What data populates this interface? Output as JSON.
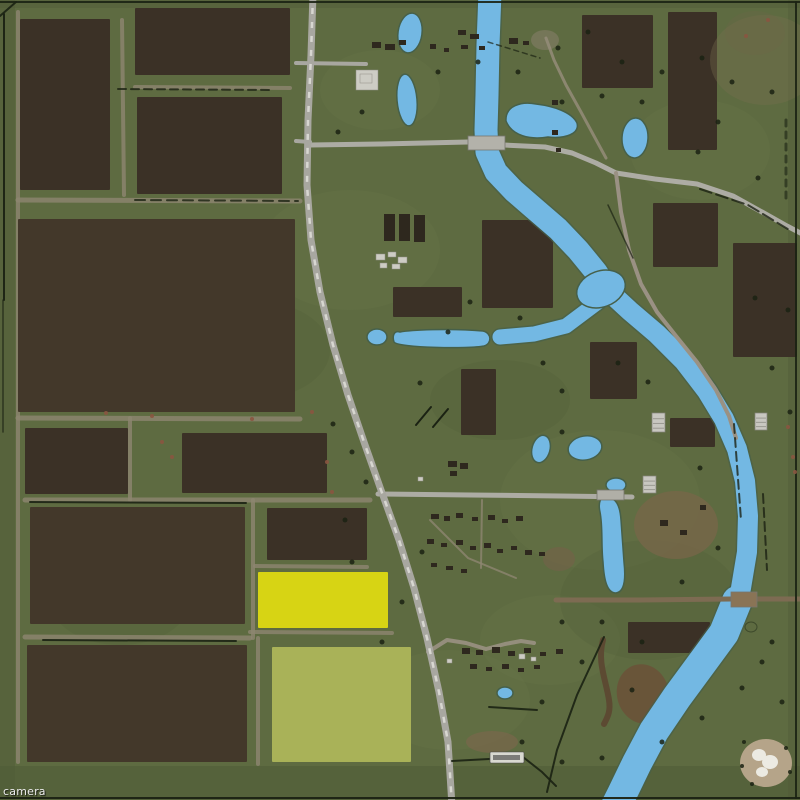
{
  "editor": {
    "camera_label": "camera"
  },
  "colors": {
    "grass": "#5e6b41",
    "water": "#73b8e3",
    "water_edge": "#46604a",
    "field_dark": "#3b3126",
    "field_dark2": "#43382a",
    "field_yellow": "#d7d414",
    "field_olive": "#a9b258",
    "road_light": "#a8a7a0",
    "road_dash": "#d8d7d1",
    "dirt_trail": "#8d8671",
    "tree": "#1b2213",
    "building_dark": "#2e281e",
    "building_light": "#cdccc4"
  },
  "fields": [
    [
      20,
      19,
      90,
      171,
      "d"
    ],
    [
      135,
      8,
      155,
      67,
      "d"
    ],
    [
      137,
      97,
      145,
      97,
      "d"
    ],
    [
      18,
      219,
      277,
      193,
      "d2"
    ],
    [
      25,
      428,
      103,
      66,
      "d"
    ],
    [
      182,
      433,
      145,
      60,
      "d"
    ],
    [
      30,
      507,
      215,
      117,
      "d2"
    ],
    [
      267,
      508,
      100,
      52,
      "d"
    ],
    [
      258,
      572,
      130,
      56,
      "y"
    ],
    [
      27,
      645,
      220,
      117,
      "d2"
    ],
    [
      272,
      647,
      139,
      115,
      "o"
    ],
    [
      582,
      15,
      71,
      73,
      "d"
    ],
    [
      668,
      12,
      49,
      138,
      "d"
    ],
    [
      653,
      203,
      65,
      64,
      "d"
    ],
    [
      733,
      243,
      64,
      114,
      "d"
    ],
    [
      482,
      220,
      71,
      88,
      "d"
    ],
    [
      393,
      287,
      69,
      30,
      "d"
    ],
    [
      461,
      369,
      35,
      66,
      "d"
    ],
    [
      590,
      342,
      47,
      57,
      "d"
    ],
    [
      670,
      418,
      45,
      29,
      "d"
    ],
    [
      628,
      622,
      82,
      31,
      "d"
    ]
  ],
  "water": {
    "river": [
      {
        "pts": "490,-8 488,45 487,95 486,130 487,152 496,172 514,191 536,210 558,229 578,250 596,272 606,288",
        "w": 23
      },
      {
        "pts": "604,287 630,311 657,334 684,361 707,391 724,419 737,449 745,481 748,516 747,552 741,588 737,607",
        "w": 20
      },
      {
        "pts": "737,601 724,633 702,663 677,697 654,731 637,763 622,794 616,806",
        "w": 30
      },
      {
        "pts": "598,302 566,326 534,334 500,337",
        "w": 15
      }
    ],
    "junction": [
      601,
      289,
      25,
      18,
      -20
    ],
    "ponds": [
      [
        410,
        33,
        12,
        20,
        8
      ],
      [
        407,
        100,
        10,
        26,
        -5
      ],
      [
        635,
        138,
        13,
        20,
        3
      ],
      [
        377,
        337,
        10,
        8,
        0
      ],
      [
        541,
        449,
        9,
        14,
        15
      ],
      [
        585,
        448,
        17,
        12,
        -10
      ],
      [
        616,
        485,
        10,
        7,
        0
      ],
      [
        505,
        693,
        8,
        6,
        0
      ]
    ],
    "blobs": [
      "M506,121 C505,106 521,101 536,104 C553,106 572,112 577,123 C580,134 565,139 548,137 C530,140 512,136 506,121 Z",
      "M400,332 C394,330 392,336 394,342 C398,348 470,349 484,346 C492,344 492,333 483,331 C450,328 410,330 400,332 Z",
      "M607,497 C600,496 598,503 600,512 C603,527 601,545 603,562 C604,580 607,593 616,593 C624,592 626,580 624,562 L621,520 C620,505 616,498 607,497 Z"
    ],
    "island": [
      751,
      627,
      6,
      5
    ]
  },
  "roads": {
    "main": {
      "pts": "313,-6 311,55 308,120 307,185 311,240 320,292 333,345 348,395 364,442 381,490 399,540 414,588 427,638 439,692 448,742 452,806",
      "w": 7
    },
    "list": [
      {
        "pts": "310,145 380,144 468,142",
        "w": 5,
        "c": "#adaca4"
      },
      {
        "pts": "504,145 545,147 572,153 596,163 616,173",
        "w": 5,
        "c": "#adaca4"
      },
      {
        "pts": "296,63 366,64",
        "w": 4,
        "c": "#a8a7a0"
      },
      {
        "pts": "296,141 310,142",
        "w": 4,
        "c": "#a8a7a0"
      },
      {
        "pts": "616,173 655,179 697,184 733,196 762,212 787,226 806,236",
        "w": 5,
        "c": "#adaca4"
      },
      {
        "pts": "616,173 621,212 629,250 641,284 657,312 676,336 697,362 716,390 729,416 736,438",
        "w": 4,
        "c": "#9a9183"
      },
      {
        "pts": "378,494 470,495 560,496 632,497",
        "w": 5,
        "c": "#adaca4"
      },
      {
        "pts": "546,38 554,60 566,85 581,112 594,136 606,158",
        "w": 3,
        "c": "#978f7c",
        "o": 0.8
      },
      {
        "pts": "428,652 447,640 466,643 486,649 505,644 521,641 534,643",
        "w": 4,
        "c": "#9a9183",
        "o": 0.9
      },
      {
        "pts": "556,600 640,600 731,599 757,599 806,599",
        "w": 5,
        "c": "#7d6b52"
      }
    ]
  },
  "bridges": [
    [
      468,
      136,
      37,
      14,
      "#b3b2aa"
    ],
    [
      731,
      592,
      26,
      15,
      "#8a7456"
    ],
    [
      597,
      490,
      27,
      10,
      "#b0afa7"
    ]
  ],
  "trails": [
    [
      "18,12 18,762",
      4
    ],
    [
      "18,418 300,419",
      5
    ],
    [
      "25,500 370,500",
      5
    ],
    [
      "25,637 250,638",
      5
    ],
    [
      "130,418 130,500",
      4
    ],
    [
      "253,500 253,638",
      4
    ],
    [
      "258,638 258,764",
      4
    ],
    [
      "135,87 290,88",
      4
    ],
    [
      "18,200 300,201",
      5
    ],
    [
      "255,566 367,567",
      4
    ],
    [
      "250,632 392,633",
      4
    ],
    [
      "122,20 124,195",
      4
    ],
    [
      "430,520 468,558 516,578",
      2
    ],
    [
      "482,500 481,568",
      2
    ]
  ],
  "treelines": [
    [
      "4,14 4,300",
      2,
      0.95,
      ""
    ],
    [
      "3,300 3,432",
      1.5,
      0.7,
      ""
    ],
    [
      "0,2 800,2",
      2,
      0.9,
      ""
    ],
    [
      "796,2 796,798",
      2,
      0.9,
      ""
    ],
    [
      "0,798 800,798",
      2,
      0.95,
      ""
    ],
    [
      "118,89 272,90",
      2,
      0.8,
      "8 5"
    ],
    [
      "135,200 298,201",
      2,
      0.8,
      "10 6"
    ],
    [
      "30,502 246,503",
      2,
      0.9,
      ""
    ],
    [
      "43,640 236,641",
      2,
      0.9,
      ""
    ],
    [
      "416,425 431,407",
      2,
      1,
      ""
    ],
    [
      "433,427 448,409",
      2,
      1,
      ""
    ],
    [
      "700,189 748,205 791,231",
      2,
      0.8,
      "12 5"
    ],
    [
      "734,424 741,520",
      2,
      0.8,
      "9 5"
    ],
    [
      "763,494 767,570",
      2,
      0.8,
      "9 5"
    ],
    [
      "604,637 577,695 557,750 547,792",
      2,
      0.9,
      ""
    ],
    [
      "489,707 537,710",
      2,
      0.9,
      ""
    ],
    [
      "452,761 489,759",
      2,
      0.9,
      ""
    ],
    [
      "523,757 542,772 556,786",
      2,
      0.9,
      ""
    ],
    [
      "0,16 16,2",
      2,
      0.9,
      ""
    ],
    [
      "488,42 540,58",
      1.5,
      0.7,
      "5 4"
    ],
    [
      "608,205 633,258",
      1.5,
      0.7,
      ""
    ],
    [
      "786,120 786,200",
      3,
      0.6,
      "6 6"
    ]
  ],
  "trees": [
    [
      333,
      424
    ],
    [
      352,
      452
    ],
    [
      366,
      482
    ],
    [
      345,
      520
    ],
    [
      420,
      383
    ],
    [
      448,
      332
    ],
    [
      470,
      302
    ],
    [
      520,
      318
    ],
    [
      543,
      363
    ],
    [
      562,
      391
    ],
    [
      618,
      363
    ],
    [
      648,
      382
    ],
    [
      562,
      432
    ],
    [
      700,
      468
    ],
    [
      718,
      548
    ],
    [
      682,
      582
    ],
    [
      602,
      622
    ],
    [
      632,
      690
    ],
    [
      662,
      742
    ],
    [
      702,
      718
    ],
    [
      422,
      552
    ],
    [
      402,
      602
    ],
    [
      382,
      642
    ],
    [
      352,
      562
    ],
    [
      562,
      622
    ],
    [
      582,
      662
    ],
    [
      542,
      702
    ],
    [
      522,
      742
    ],
    [
      562,
      762
    ],
    [
      602,
      758
    ],
    [
      642,
      642
    ],
    [
      762,
      662
    ],
    [
      782,
      702
    ],
    [
      742,
      688
    ],
    [
      772,
      642
    ],
    [
      588,
      32
    ],
    [
      558,
      48
    ],
    [
      622,
      62
    ],
    [
      662,
      72
    ],
    [
      702,
      58
    ],
    [
      732,
      82
    ],
    [
      772,
      92
    ],
    [
      642,
      102
    ],
    [
      602,
      96
    ],
    [
      562,
      102
    ],
    [
      518,
      72
    ],
    [
      478,
      62
    ],
    [
      438,
      72
    ],
    [
      362,
      112
    ],
    [
      338,
      132
    ],
    [
      755,
      298
    ],
    [
      788,
      310
    ],
    [
      772,
      368
    ],
    [
      790,
      412
    ],
    [
      758,
      178
    ],
    [
      718,
      122
    ],
    [
      698,
      152
    ]
  ],
  "bushes": [
    [
      152,
      416
    ],
    [
      162,
      442
    ],
    [
      172,
      457
    ],
    [
      252,
      419
    ],
    [
      106,
      413
    ],
    [
      312,
      412
    ],
    [
      327,
      462
    ],
    [
      332,
      492
    ],
    [
      788,
      427
    ],
    [
      793,
      457
    ],
    [
      795,
      472
    ],
    [
      768,
      20
    ],
    [
      746,
      36
    ]
  ],
  "buildings": {
    "dark": [
      [
        372,
        42,
        9,
        6
      ],
      [
        385,
        44,
        10,
        6
      ],
      [
        399,
        40,
        7,
        5
      ],
      [
        430,
        44,
        6,
        5
      ],
      [
        444,
        48,
        5,
        4
      ],
      [
        458,
        30,
        8,
        5
      ],
      [
        470,
        34,
        9,
        5
      ],
      [
        461,
        45,
        7,
        4
      ],
      [
        479,
        46,
        6,
        4
      ],
      [
        509,
        38,
        9,
        6
      ],
      [
        523,
        41,
        6,
        4
      ],
      [
        384,
        214,
        11,
        27
      ],
      [
        399,
        214,
        11,
        27
      ],
      [
        414,
        215,
        11,
        27
      ],
      [
        431,
        514,
        8,
        5
      ],
      [
        444,
        516,
        6,
        5
      ],
      [
        456,
        513,
        7,
        5
      ],
      [
        472,
        517,
        6,
        4
      ],
      [
        488,
        515,
        7,
        5
      ],
      [
        502,
        519,
        6,
        4
      ],
      [
        516,
        516,
        7,
        5
      ],
      [
        427,
        539,
        7,
        5
      ],
      [
        441,
        543,
        6,
        4
      ],
      [
        456,
        540,
        7,
        5
      ],
      [
        470,
        546,
        6,
        4
      ],
      [
        484,
        543,
        7,
        5
      ],
      [
        497,
        549,
        6,
        4
      ],
      [
        511,
        546,
        6,
        4
      ],
      [
        525,
        550,
        7,
        5
      ],
      [
        539,
        552,
        6,
        4
      ],
      [
        431,
        563,
        6,
        4
      ],
      [
        446,
        566,
        7,
        4
      ],
      [
        461,
        569,
        6,
        4
      ],
      [
        448,
        461,
        9,
        6
      ],
      [
        460,
        463,
        8,
        6
      ],
      [
        450,
        471,
        7,
        5
      ],
      [
        462,
        648,
        8,
        6
      ],
      [
        476,
        650,
        7,
        5
      ],
      [
        492,
        647,
        8,
        6
      ],
      [
        508,
        651,
        7,
        5
      ],
      [
        524,
        648,
        7,
        5
      ],
      [
        540,
        652,
        6,
        4
      ],
      [
        556,
        649,
        7,
        5
      ],
      [
        470,
        664,
        7,
        5
      ],
      [
        486,
        667,
        6,
        4
      ],
      [
        502,
        664,
        7,
        5
      ],
      [
        518,
        668,
        6,
        4
      ],
      [
        534,
        665,
        6,
        4
      ],
      [
        660,
        520,
        8,
        6
      ],
      [
        680,
        530,
        7,
        5
      ],
      [
        700,
        505,
        6,
        5
      ],
      [
        552,
        100,
        6,
        5
      ],
      [
        552,
        130,
        6,
        5
      ],
      [
        556,
        148,
        5,
        4
      ]
    ],
    "light": [
      [
        356,
        70,
        22,
        20
      ],
      [
        360,
        74,
        12,
        9
      ],
      [
        376,
        254,
        9,
        6
      ],
      [
        388,
        252,
        8,
        5
      ],
      [
        398,
        257,
        9,
        6
      ],
      [
        380,
        263,
        7,
        5
      ],
      [
        392,
        264,
        8,
        5
      ],
      [
        519,
        654,
        6,
        5
      ],
      [
        531,
        657,
        5,
        4
      ],
      [
        447,
        659,
        5,
        4
      ],
      [
        418,
        477,
        5,
        4
      ]
    ],
    "sheds": [
      [
        652,
        413,
        13,
        19
      ],
      [
        755,
        413,
        12,
        17
      ],
      [
        643,
        476,
        13,
        17
      ]
    ]
  },
  "patches": {
    "strips": [
      [
        0,
        766,
        800,
        34,
        "#4f5b37",
        0.55
      ],
      [
        0,
        0,
        15,
        800,
        "#4f5b37",
        0.5
      ],
      [
        0,
        0,
        800,
        8,
        "#4f5b37",
        0.4
      ],
      [
        788,
        0,
        12,
        800,
        "#4f5b37",
        0.4
      ]
    ],
    "light_grass": [
      [
        350,
        250,
        90,
        60
      ],
      [
        600,
        500,
        100,
        70
      ],
      [
        450,
        700,
        80,
        50
      ],
      [
        700,
        150,
        70,
        50
      ],
      [
        380,
        90,
        60,
        40
      ],
      [
        550,
        640,
        70,
        45
      ]
    ],
    "dark_grass": [
      [
        250,
        350,
        80,
        50
      ],
      [
        650,
        600,
        90,
        60
      ],
      [
        500,
        400,
        70,
        40
      ],
      [
        120,
        600,
        70,
        45
      ]
    ],
    "dirt": [
      [
        643,
        694,
        26,
        30,
        -15,
        "#6b5138",
        0.85
      ],
      [
        765,
        60,
        55,
        45,
        0,
        "#78714f",
        0.35
      ],
      [
        755,
        33,
        30,
        22,
        0,
        "#6e6749",
        0.3
      ],
      [
        559,
        559,
        16,
        12,
        0,
        "#74614a",
        0.6
      ],
      [
        492,
        742,
        26,
        11,
        0,
        "#79674c",
        0.7
      ],
      [
        676,
        525,
        42,
        34,
        0,
        "#776649",
        0.8
      ],
      [
        545,
        40,
        14,
        10,
        0,
        "#8b8270",
        0.5
      ]
    ],
    "streaks": [
      {
        "d": "M603,640 C597,662 606,680 609,700 C611,712 607,718 604,724",
        "c": "#5c4430",
        "w": 6,
        "o": 0.85
      }
    ]
  },
  "quarry": {
    "base": [
      766,
      763,
      26,
      24,
      "#b5a489"
    ],
    "blobs": [
      [
        759,
        755,
        7,
        6
      ],
      [
        770,
        762,
        8,
        7
      ],
      [
        762,
        772,
        6,
        5
      ]
    ],
    "dots": [
      [
        744,
        742
      ],
      [
        786,
        748
      ],
      [
        790,
        772
      ],
      [
        752,
        784
      ],
      [
        742,
        766
      ]
    ]
  },
  "sign": {
    "rect": [
      490,
      752,
      34,
      11
    ],
    "smudge": [
      493,
      755,
      27,
      5
    ]
  }
}
